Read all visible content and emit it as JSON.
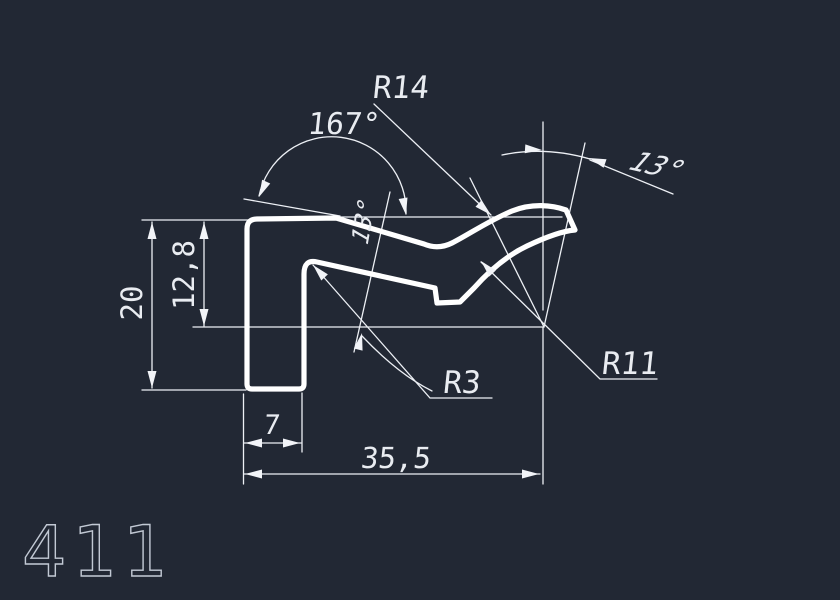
{
  "drawing": {
    "part_number": "411",
    "dimensions": {
      "angle_top": "167°",
      "radius_top": "R14",
      "angle_tip": "13°",
      "angle_slope": "13°",
      "height_total": "20",
      "height_reference": "12,8",
      "radius_fillet": "R3",
      "radius_concave": "R11",
      "foot_width": "7",
      "total_width": "35,5"
    },
    "colors": {
      "background": "#222834",
      "profile_line": "#ffffff",
      "dimension_line": "#edf0f5",
      "part_number_color": "#c2c9d4"
    }
  }
}
